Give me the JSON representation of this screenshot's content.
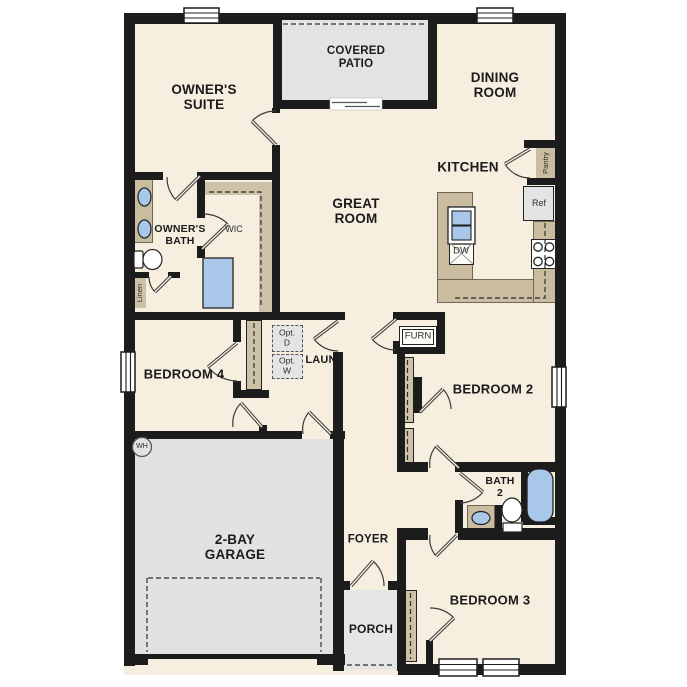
{
  "plan_title": "single-story floor plan",
  "rooms": {
    "owners_suite": {
      "label": "OWNER'S\nSUITE"
    },
    "covered_patio": {
      "label": "COVERED\nPATIO"
    },
    "dining_room": {
      "label": "DINING\nROOM"
    },
    "kitchen": {
      "label": "KITCHEN"
    },
    "great_room": {
      "label": "GREAT\nROOM"
    },
    "owners_bath": {
      "label": "OWNER'S\nBATH"
    },
    "wic": {
      "label": "WIC"
    },
    "linen_closet": {
      "label": "Linen"
    },
    "pantry": {
      "label": "Pantry"
    },
    "laundry": {
      "label": "LAUN"
    },
    "optional_dryer": {
      "label": "Opt.\nD"
    },
    "optional_washer": {
      "label": "Opt.\nW"
    },
    "furnace_closet": {
      "label": "FURN"
    },
    "bedroom_2": {
      "label": "BEDROOM 2"
    },
    "bedroom_3": {
      "label": "BEDROOM 3"
    },
    "bedroom_4": {
      "label": "BEDROOM 4"
    },
    "bath_2": {
      "label": "BATH\n2"
    },
    "garage": {
      "label": "2-BAY\nGARAGE"
    },
    "foyer": {
      "label": "FOYER"
    },
    "porch": {
      "label": "PORCH"
    }
  },
  "appliances": {
    "refrigerator": "Ref",
    "dishwasher": "DW",
    "water_heater": "WH"
  },
  "fixtures": [
    "double-vanity-sinks",
    "toilet",
    "shower",
    "walk-in-closet-shelf",
    "kitchen-island-sink",
    "dishwasher",
    "range-4-burner",
    "refrigerator",
    "bathtub",
    "vanity-sink",
    "bifold-closet-doors",
    "garage-door",
    "sliding-patio-door",
    "windows",
    "door-swing-arcs"
  ],
  "colors": {
    "floor": "#f6eede",
    "wall": "#1c1c1c",
    "garage_patio_gray": "#e2e2e0",
    "porch_gray": "#e6e6e4",
    "counter_tan": "#c9bc9f",
    "closet_tan": "#cdc1a7",
    "fixture_blue": "#a9c7e8",
    "appliance_gray": "#e4e4e4"
  }
}
